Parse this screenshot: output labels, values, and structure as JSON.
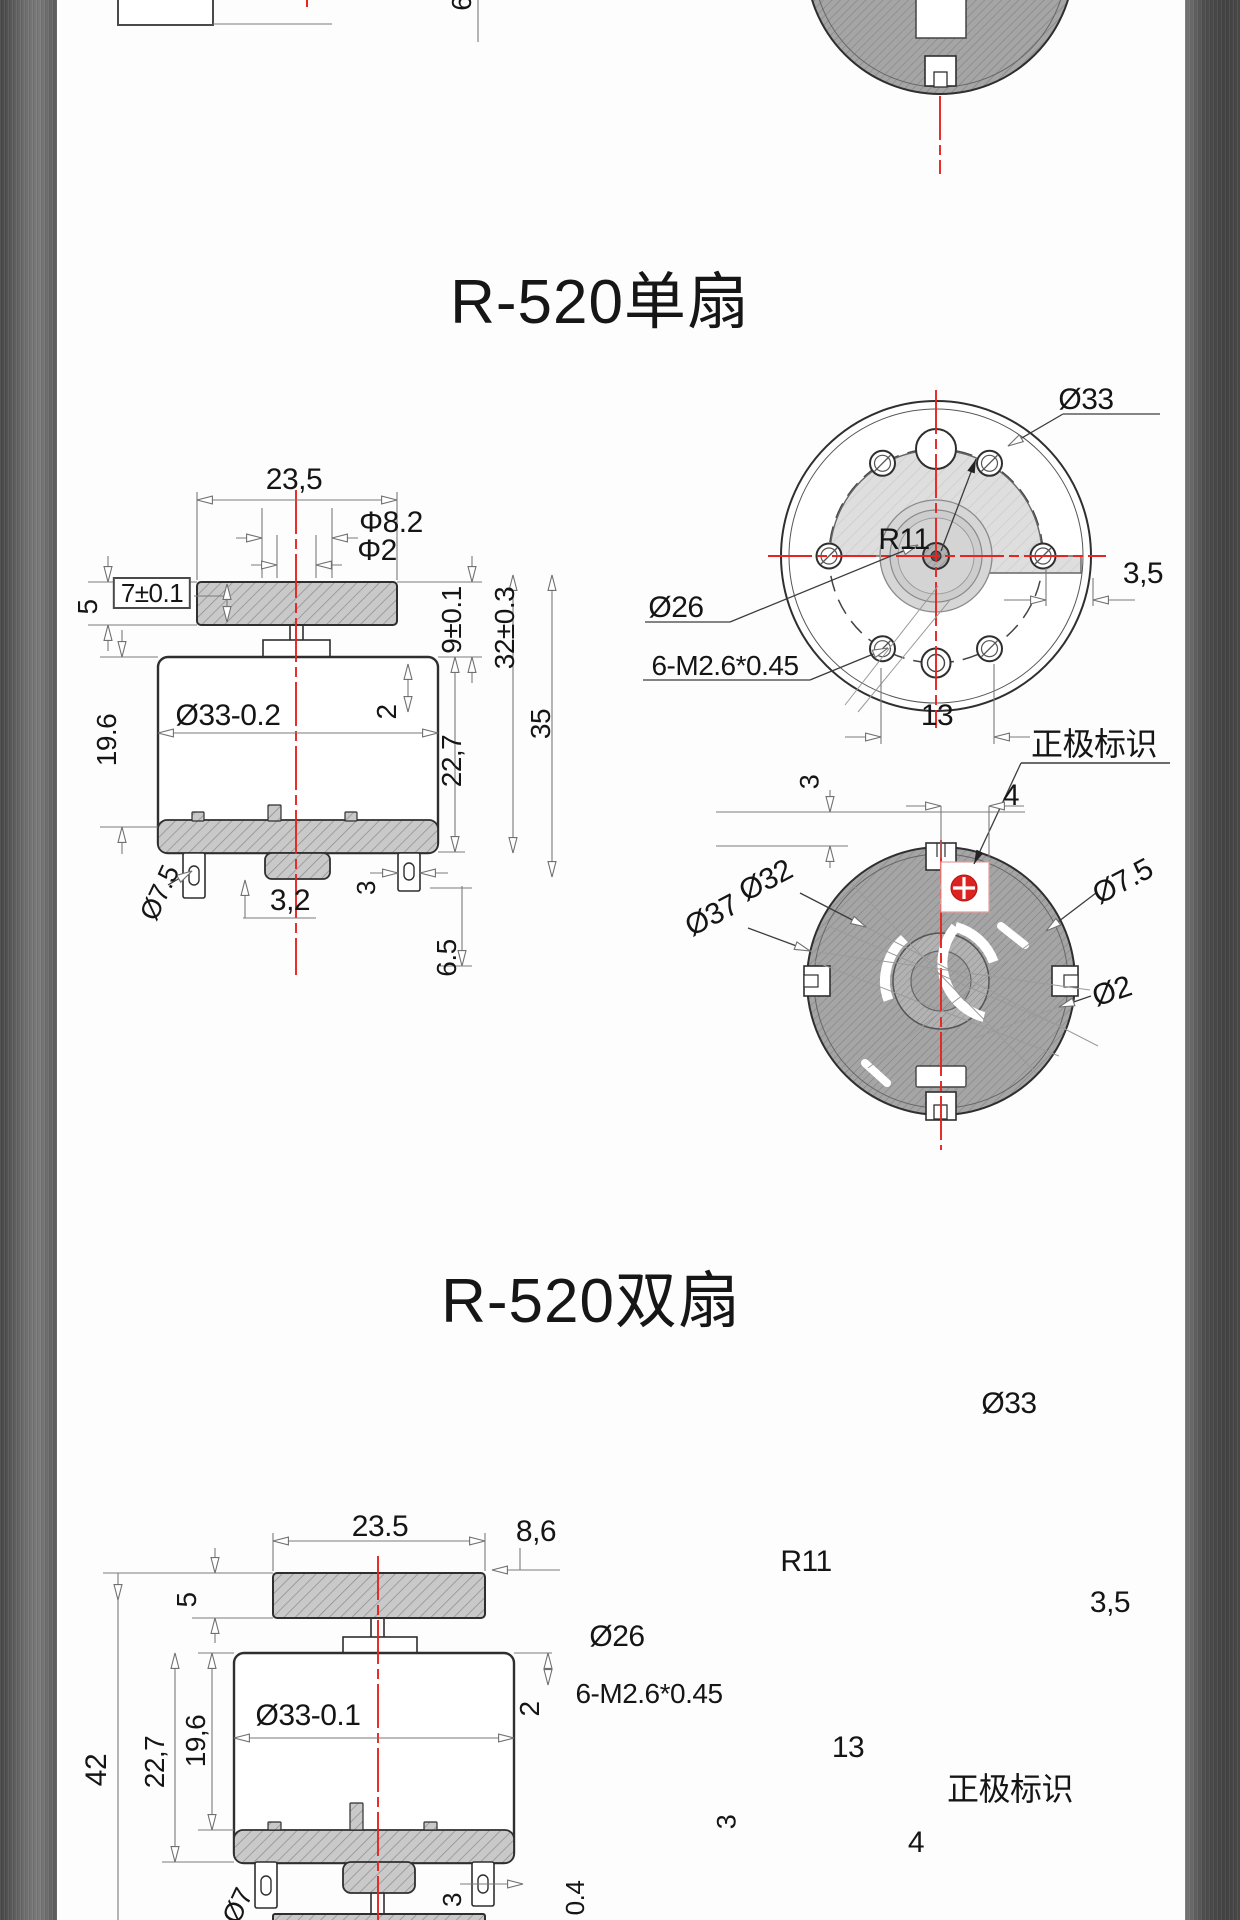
{
  "page": {
    "title1": "R-520单扇",
    "title2": "R-520双扇"
  },
  "colors": {
    "accent_red": "#e8241f",
    "metal_gray": "#5a5a5a",
    "line_dark": "#2f2f2f"
  },
  "labels": [
    {
      "n": "dim-fan-width",
      "t": "23,5",
      "x": 294,
      "y": 480,
      "r": 0,
      "s": 30
    },
    {
      "n": "dim-bearing-dia",
      "t": "Φ8.2",
      "x": 391,
      "y": 523,
      "r": 0,
      "s": 30
    },
    {
      "n": "dim-shaft-dia",
      "t": "Φ2",
      "x": 377,
      "y": 551,
      "r": 0,
      "s": 30
    },
    {
      "n": "dim-fan-thickness",
      "t": "7±0.1",
      "x": 152,
      "y": 593,
      "r": 0,
      "s": 26,
      "c": "boxed"
    },
    {
      "n": "dim-5",
      "t": "5",
      "x": 88,
      "y": 607,
      "r": -90,
      "s": 28
    },
    {
      "n": "dim-9-tol",
      "t": "9±0.1",
      "x": 452,
      "y": 620,
      "r": -90,
      "s": 28
    },
    {
      "n": "dim-19-6",
      "t": "19.6",
      "x": 107,
      "y": 740,
      "r": -90,
      "s": 28
    },
    {
      "n": "dim-body-dia",
      "t": "Ø33-0.2",
      "x": 228,
      "y": 716,
      "r": 0,
      "s": 30
    },
    {
      "n": "dim-2",
      "t": "2",
      "x": 387,
      "y": 712,
      "r": -90,
      "s": 28
    },
    {
      "n": "dim-22-7",
      "t": "22,7",
      "x": 452,
      "y": 761,
      "r": -90,
      "s": 28
    },
    {
      "n": "dim-32-tol",
      "t": "32±0.3",
      "x": 505,
      "y": 628,
      "r": -90,
      "s": 28
    },
    {
      "n": "dim-35",
      "t": "35",
      "x": 541,
      "y": 724,
      "r": -90,
      "s": 28
    },
    {
      "n": "dim-terminal-o7-5",
      "t": "Ø7.5",
      "x": 160,
      "y": 893,
      "r": -65,
      "s": 27
    },
    {
      "n": "dim-3-2",
      "t": "3,2",
      "x": 290,
      "y": 901,
      "r": 0,
      "s": 30
    },
    {
      "n": "dim-3-terminal",
      "t": "3",
      "x": 366,
      "y": 888,
      "r": -90,
      "s": 26
    },
    {
      "n": "dim-6-5",
      "t": "6.5",
      "x": 447,
      "y": 958,
      "r": -90,
      "s": 28
    },
    {
      "n": "dim-o33-top",
      "t": "Ø33",
      "x": 1086,
      "y": 400,
      "r": 0,
      "s": 30
    },
    {
      "n": "dim-3-5-top",
      "t": "3,5",
      "x": 1143,
      "y": 574,
      "r": 0,
      "s": 30
    },
    {
      "n": "dim-o26",
      "t": "Ø26",
      "x": 676,
      "y": 608,
      "r": 0,
      "s": 30
    },
    {
      "n": "dim-screws",
      "t": "6-M2.6*0.45",
      "x": 725,
      "y": 666,
      "r": 0,
      "s": 28
    },
    {
      "n": "dim-r11",
      "t": "R11",
      "x": 904,
      "y": 540,
      "r": 0,
      "s": 30
    },
    {
      "n": "dim-13",
      "t": "13",
      "x": 937,
      "y": 716,
      "r": 0,
      "s": 30
    },
    {
      "n": "label-polarity-mark",
      "t": "正极标识",
      "x": 1094,
      "y": 744,
      "r": 0,
      "s": 32
    },
    {
      "n": "dim-4",
      "t": "4",
      "x": 1011,
      "y": 796,
      "r": 0,
      "s": 30
    },
    {
      "n": "dim-3-bottom",
      "t": "3",
      "x": 810,
      "y": 782,
      "r": -90,
      "s": 27
    },
    {
      "n": "dim-o32",
      "t": "Ø32",
      "x": 766,
      "y": 881,
      "r": -28,
      "s": 30
    },
    {
      "n": "dim-o37",
      "t": "Ø37",
      "x": 712,
      "y": 916,
      "r": -28,
      "s": 30
    },
    {
      "n": "dim-o7-5-bottom",
      "t": "Ø7.5",
      "x": 1123,
      "y": 882,
      "r": -28,
      "s": 30
    },
    {
      "n": "dim-o2",
      "t": "Ø2",
      "x": 1112,
      "y": 992,
      "r": -18,
      "s": 30
    },
    {
      "n": "dim2-fan-width",
      "t": "23.5",
      "x": 380,
      "y": 1527,
      "r": 0,
      "s": 30
    },
    {
      "n": "dim2-5",
      "t": "5",
      "x": 187,
      "y": 1600,
      "r": -90,
      "s": 28
    },
    {
      "n": "dim2-8-6",
      "t": "8,6",
      "x": 536,
      "y": 1532,
      "r": 0,
      "s": 30
    },
    {
      "n": "dim2-42",
      "t": "42",
      "x": 97,
      "y": 1770,
      "r": -90,
      "s": 30
    },
    {
      "n": "dim2-22-7",
      "t": "22,7",
      "x": 155,
      "y": 1762,
      "r": -90,
      "s": 28
    },
    {
      "n": "dim2-19-6",
      "t": "19,6",
      "x": 196,
      "y": 1741,
      "r": -90,
      "s": 28
    },
    {
      "n": "dim2-body-dia",
      "t": "Ø33-0.1",
      "x": 308,
      "y": 1716,
      "r": 0,
      "s": 30
    },
    {
      "n": "dim2-2",
      "t": "2",
      "x": 530,
      "y": 1709,
      "r": -90,
      "s": 28
    },
    {
      "n": "dim2-3-terminal",
      "t": "3",
      "x": 452,
      "y": 1900,
      "r": -90,
      "s": 26
    },
    {
      "n": "dim2-0-4",
      "t": "0.4",
      "x": 575,
      "y": 1898,
      "r": -90,
      "s": 26
    },
    {
      "n": "dim2-o7-partial",
      "t": "Ø7",
      "x": 238,
      "y": 1906,
      "r": -65,
      "s": 27
    },
    {
      "n": "dim2-o33-top",
      "t": "Ø33",
      "x": 1009,
      "y": 1404,
      "r": 0,
      "s": 30
    },
    {
      "n": "dim2-3-5-top",
      "t": "3,5",
      "x": 1110,
      "y": 1603,
      "r": 0,
      "s": 30
    },
    {
      "n": "dim2-o26",
      "t": "Ø26",
      "x": 617,
      "y": 1637,
      "r": 0,
      "s": 30
    },
    {
      "n": "dim2-screws",
      "t": "6-M2.6*0.45",
      "x": 649,
      "y": 1694,
      "r": 0,
      "s": 28
    },
    {
      "n": "dim2-r11",
      "t": "R11",
      "x": 806,
      "y": 1562,
      "r": 0,
      "s": 30
    },
    {
      "n": "dim2-13",
      "t": "13",
      "x": 848,
      "y": 1748,
      "r": 0,
      "s": 30
    },
    {
      "n": "label2-polarity-mark",
      "t": "正极标识",
      "x": 1010,
      "y": 1789,
      "r": 0,
      "s": 32
    },
    {
      "n": "dim2-4",
      "t": "4",
      "x": 916,
      "y": 1843,
      "r": 0,
      "s": 30
    },
    {
      "n": "dim2-3-bottom",
      "t": "3",
      "x": 727,
      "y": 1822,
      "r": -90,
      "s": 27
    },
    {
      "n": "remnant-dim-box",
      "t": "7±0.1",
      "x": 165,
      "y": -10,
      "r": 0,
      "s": 27
    },
    {
      "n": "remnant-dim-6-5",
      "t": "6.5",
      "x": 462,
      "y": -8,
      "r": -90,
      "s": 28
    }
  ]
}
